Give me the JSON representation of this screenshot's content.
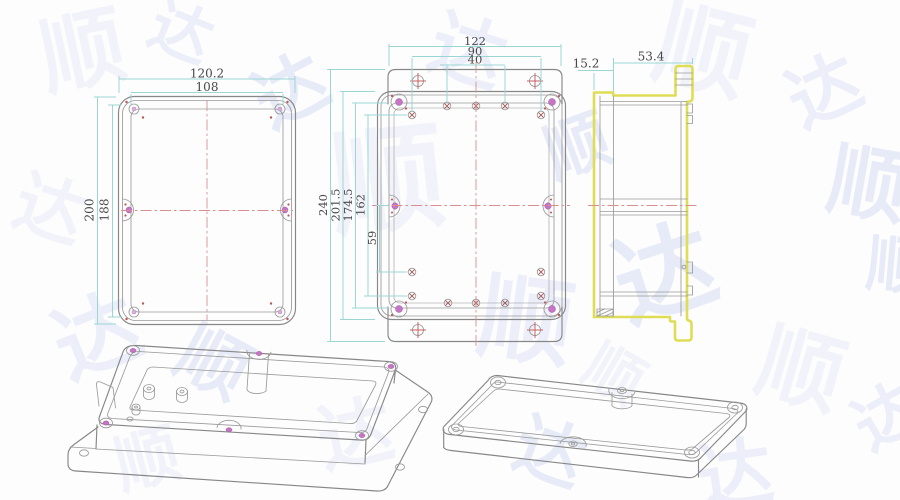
{
  "watermark": {
    "text": "顺达",
    "color": "#e5e9f7"
  },
  "colors": {
    "dimension_line": "#9cd6d4",
    "dimension_text": "#484848",
    "outline": "#878787",
    "centerline": "#d98f8f",
    "screw_hole": "#c774c7",
    "crosshair": "#c65c5c",
    "selected_highlight": "#dedd55",
    "background": "#fdfdfe"
  },
  "drawing": {
    "cover_top_view": {
      "label": "cover top view",
      "dim_width_outer": "120.2",
      "dim_width_inner": "108",
      "dim_height_outer": "200",
      "dim_height_inner": "188"
    },
    "base_top_view": {
      "label": "base top view",
      "dim_width_flange": "122",
      "dim_width_holes_outer": "90",
      "dim_width_holes_inner": "40",
      "dim_height_overall": "240",
      "dim_height_body": "201.5",
      "dim_height_cavity": "174.5",
      "dim_height_holes": "162",
      "dim_center_to_hole": "59"
    },
    "side_view": {
      "label": "side view",
      "dim_lid_thickness": "15.2",
      "dim_base_depth": "53.4"
    }
  }
}
